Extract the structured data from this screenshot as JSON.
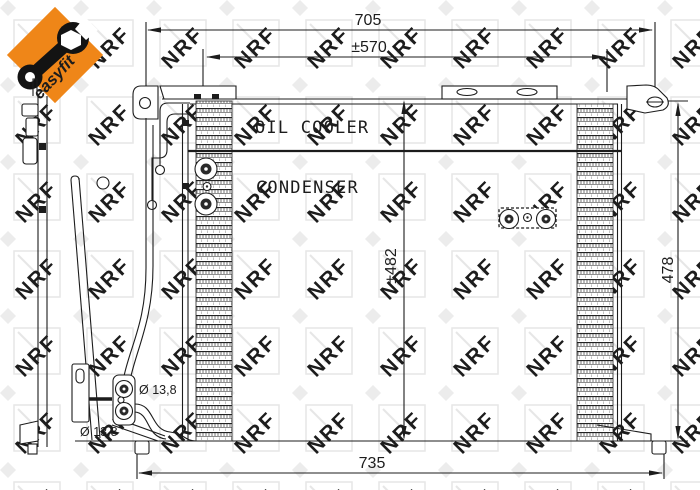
{
  "watermark": {
    "text": "NRF",
    "color": "#dcdcdc"
  },
  "logo": {
    "label": "easyfit",
    "bg_color": "#EF8618",
    "icon": "wrench-icon",
    "icon_color": "#131313"
  },
  "drawing": {
    "line_color": "#1c1c1c",
    "labels": {
      "oil_cooler": "OIL COOLER",
      "condenser": "CONDENSER"
    },
    "dimensions": {
      "top_width": "705",
      "bracket_span": "±570",
      "core_height": "±482",
      "side_height": "478",
      "bottom_width": "735",
      "port_diameter_top": "Ø 13,8",
      "port_diameter_bottom": "Ø 13,8"
    }
  }
}
